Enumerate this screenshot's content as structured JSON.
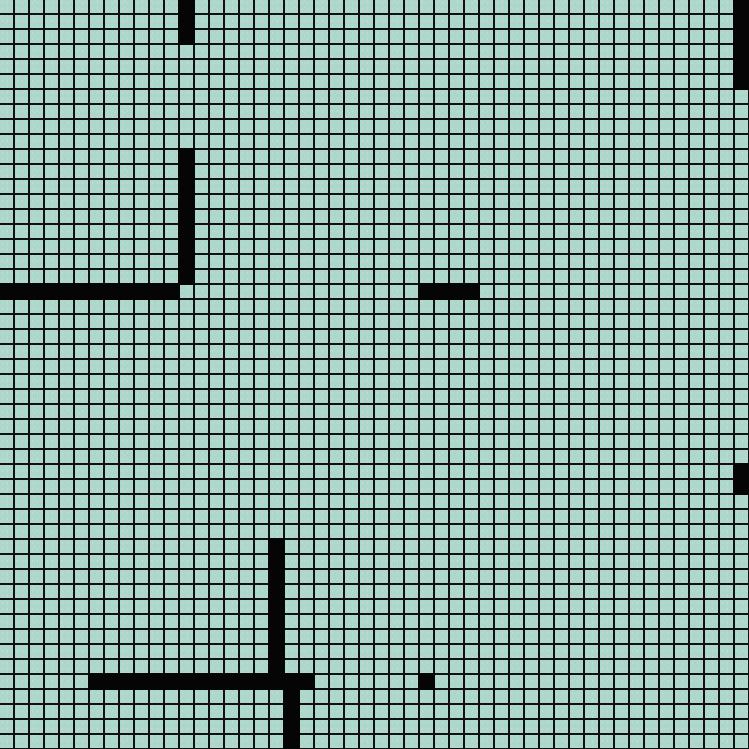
{
  "board": {
    "cols": 50,
    "rows": 50,
    "cell_px": 15,
    "grid_line_px": 1.8,
    "colors": {
      "background": "#aed7cc",
      "grid_line": "#101010",
      "wall": "#050505"
    }
  },
  "walls": [
    {
      "name": "wall-top-vertical",
      "col": 12,
      "row": 0,
      "w": 1,
      "h": 3
    },
    {
      "name": "wall-left-vertical",
      "col": 12,
      "row": 10,
      "w": 1,
      "h": 9
    },
    {
      "name": "wall-left-horizontal",
      "col": 0,
      "row": 19,
      "w": 12,
      "h": 1
    },
    {
      "name": "wall-center-horizontal",
      "col": 28,
      "row": 19,
      "w": 4,
      "h": 1
    },
    {
      "name": "wall-right-edge-top",
      "col": 49,
      "row": 0,
      "w": 1,
      "h": 6
    },
    {
      "name": "wall-right-edge-middle",
      "col": 49,
      "row": 31,
      "w": 1,
      "h": 2
    },
    {
      "name": "wall-bottom-vertical-upper",
      "col": 18,
      "row": 36,
      "w": 1,
      "h": 9
    },
    {
      "name": "wall-bottom-horizontal",
      "col": 6,
      "row": 45,
      "w": 15,
      "h": 1
    },
    {
      "name": "wall-bottom-vertical-lower",
      "col": 19,
      "row": 46,
      "w": 1,
      "h": 4
    },
    {
      "name": "wall-dot",
      "col": 28,
      "row": 45,
      "w": 1,
      "h": 1
    }
  ]
}
